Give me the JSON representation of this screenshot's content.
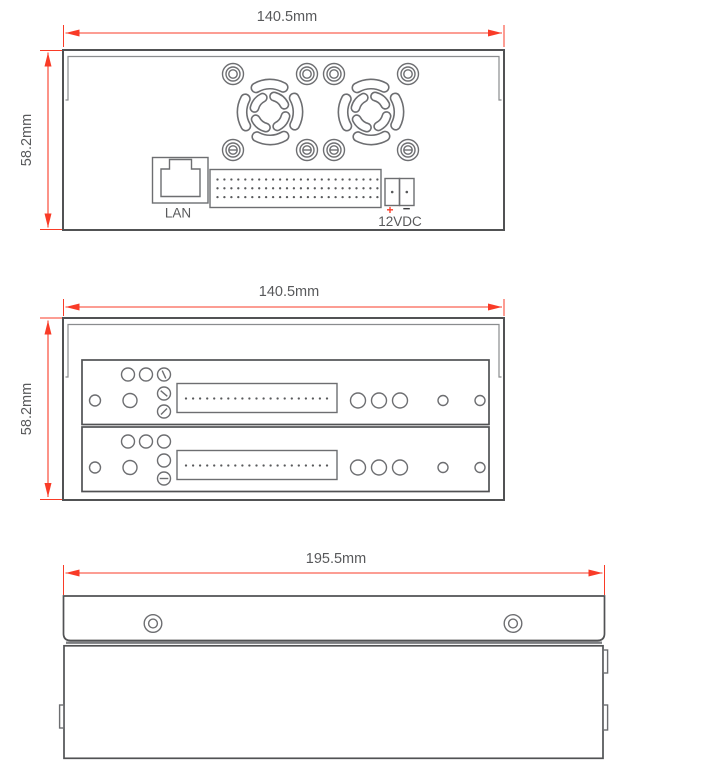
{
  "colors": {
    "dim_red": "#f93b27",
    "line_dark": "#515254",
    "line_mid": "#6d6e71",
    "line_light": "#8a8c8e",
    "label_gray": "#58595b"
  },
  "views": {
    "rear": {
      "width_label": "140.5mm",
      "height_label": "58.2mm",
      "lan_label": "LAN",
      "power_label": "12VDC",
      "power_plus": "+",
      "power_minus": "−"
    },
    "front": {
      "width_label": "140.5mm",
      "height_label": "58.2mm"
    },
    "top": {
      "width_label": "195.5mm"
    }
  }
}
